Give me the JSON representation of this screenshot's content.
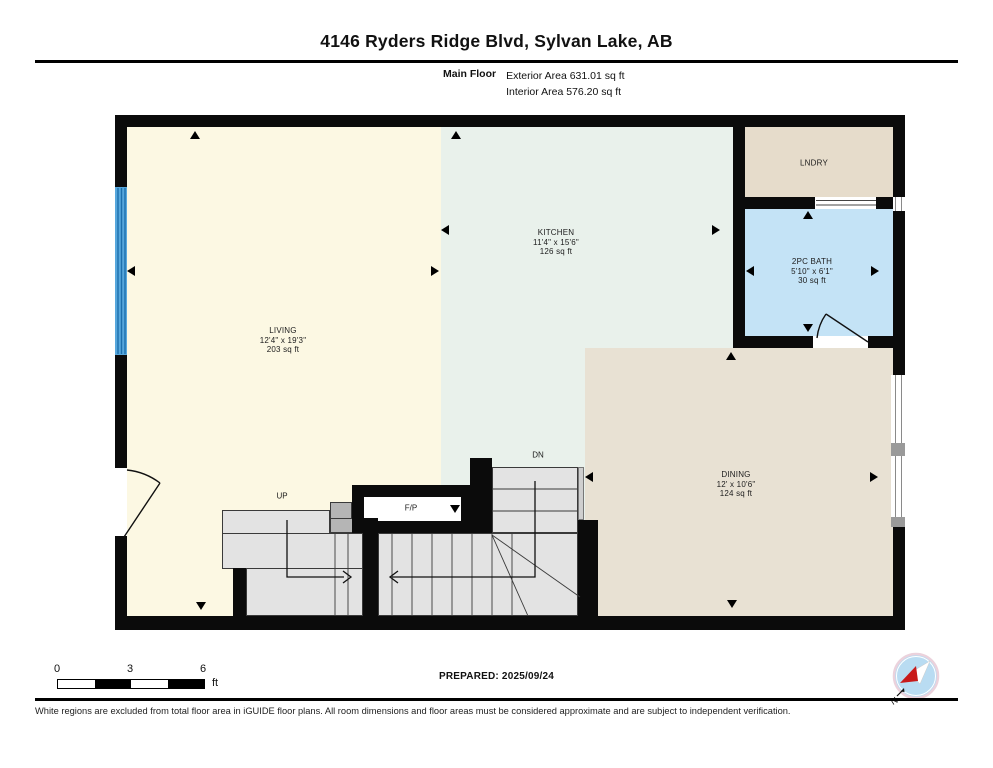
{
  "header": {
    "title": "4146 Ryders Ridge Blvd, Sylvan Lake, AB",
    "floor_label": "Main Floor",
    "exterior_area": "Exterior Area 631.01 sq ft",
    "interior_area": "Interior Area 576.20 sq ft"
  },
  "rooms": {
    "living": {
      "name": "LIVING",
      "dimensions": "12'4\" x 19'3\"",
      "area": "203 sq ft"
    },
    "kitchen": {
      "name": "KITCHEN",
      "dimensions": "11'4\" x 15'6\"",
      "area": "126 sq ft"
    },
    "laundry": {
      "name": "LNDRY"
    },
    "bath": {
      "name": "2PC BATH",
      "dimensions": "5'10\" x 6'1\"",
      "area": "30 sq ft"
    },
    "dining": {
      "name": "DINING",
      "dimensions": "12' x 10'6\"",
      "area": "124 sq ft"
    }
  },
  "stairs": {
    "up_label": "UP",
    "down_label": "DN",
    "fireplace_label": "F/P"
  },
  "scale_bar": {
    "tick0": "0",
    "tick1": "3",
    "tick2": "6",
    "unit": "ft"
  },
  "prepared": "PREPARED: 2025/09/24",
  "disclaimer": "White regions are excluded from total floor area in iGUIDE floor plans. All room dimensions and floor areas must be considered approximate and are subject to independent verification.",
  "compass": {
    "north_label": "N"
  },
  "colors": {
    "living": "#FCF8E3",
    "kitchen": "#E9F1EB",
    "laundry": "#E6DCCB",
    "bath": "#C4E3F6",
    "dining": "#E8E1D3",
    "wall": "#0B0B0B",
    "window_blue": "#57A7DC",
    "needle_red": "#C81A1A"
  }
}
